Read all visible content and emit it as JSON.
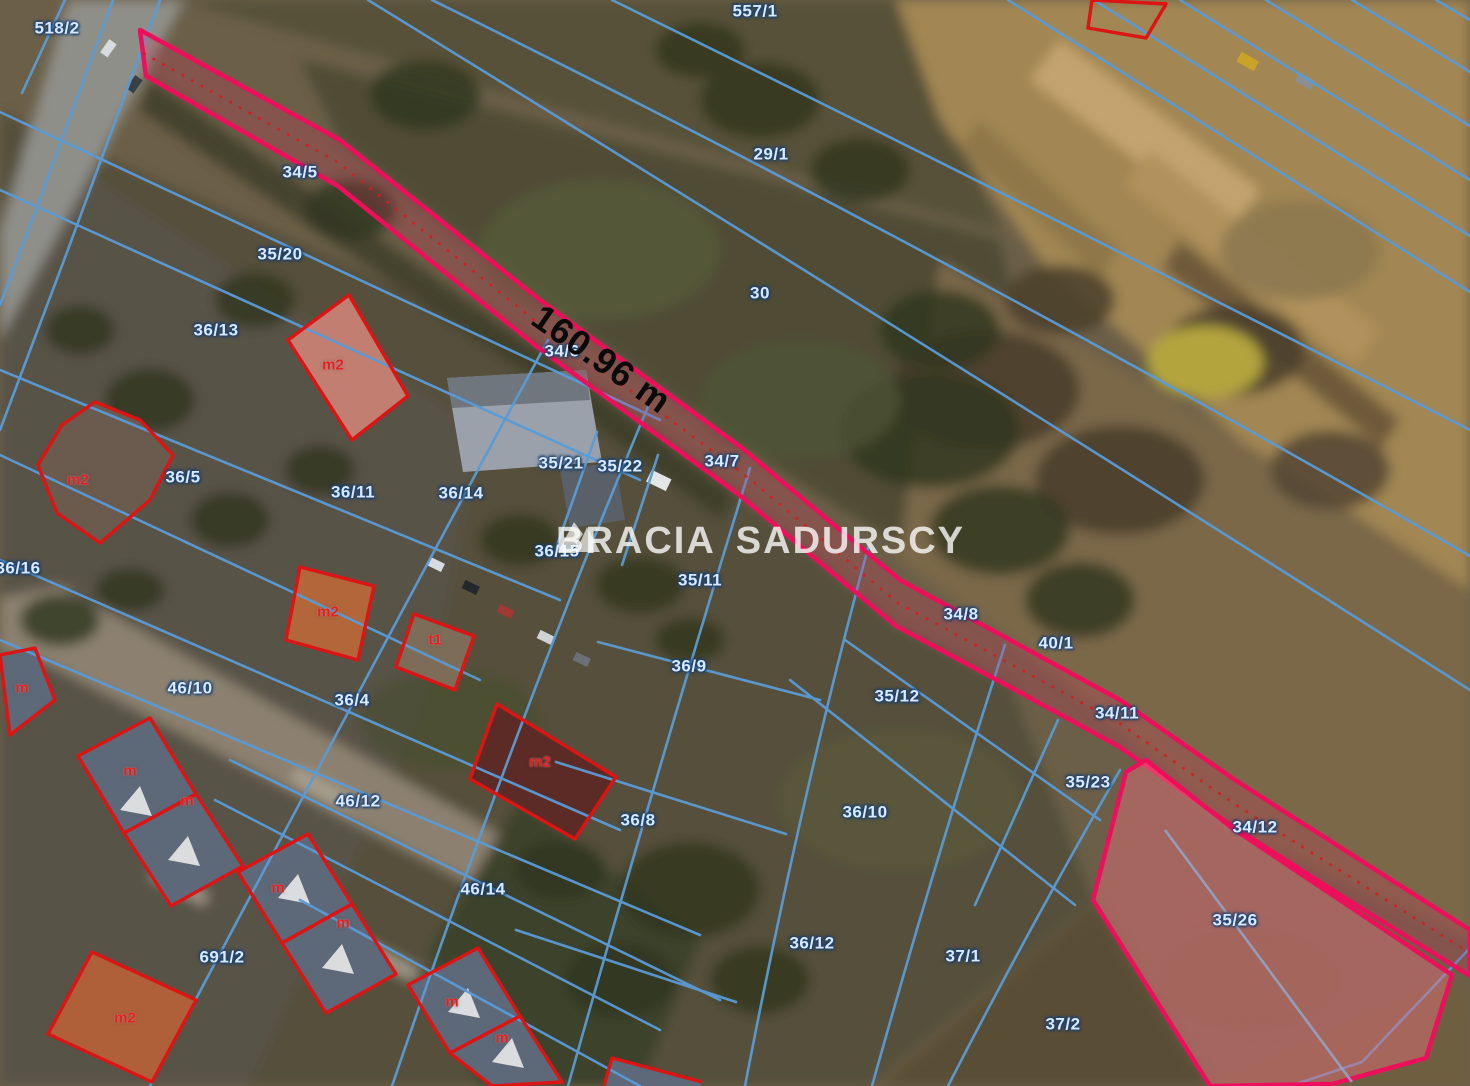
{
  "watermark": {
    "part1": "BRACIA",
    "part2": "SADURSCY",
    "logo": "triangle-logo"
  },
  "measurement": {
    "text": "160.96 m"
  },
  "colors": {
    "boundary_blue": "#5a9bd6",
    "highlight_magenta": "#ee0f5c",
    "building_red": "#dd1414",
    "parcel_label": "#dceaff",
    "building_label": "#e61e1e",
    "measurement_text": "#0a0a0a"
  },
  "parcel_labels": [
    {
      "text": "518/2",
      "x": 57,
      "y": 28
    },
    {
      "text": "557/1",
      "x": 755,
      "y": 11
    },
    {
      "text": "29/1",
      "x": 771,
      "y": 154
    },
    {
      "text": "30",
      "x": 760,
      "y": 293
    },
    {
      "text": "34/5",
      "x": 300,
      "y": 172
    },
    {
      "text": "35/20",
      "x": 280,
      "y": 254
    },
    {
      "text": "36/13",
      "x": 216,
      "y": 330
    },
    {
      "text": "34/6",
      "x": 562,
      "y": 351
    },
    {
      "text": "35/21",
      "x": 561,
      "y": 463
    },
    {
      "text": "35/22",
      "x": 620,
      "y": 466
    },
    {
      "text": "34/7",
      "x": 722,
      "y": 461
    },
    {
      "text": "36/5",
      "x": 183,
      "y": 477
    },
    {
      "text": "36/11",
      "x": 353,
      "y": 492
    },
    {
      "text": "36/14",
      "x": 461,
      "y": 493
    },
    {
      "text": "36/16",
      "x": 18,
      "y": 568
    },
    {
      "text": "36/15",
      "x": 557,
      "y": 551
    },
    {
      "text": "35/11",
      "x": 700,
      "y": 580
    },
    {
      "text": "34/8",
      "x": 961,
      "y": 614
    },
    {
      "text": "40/1",
      "x": 1056,
      "y": 643
    },
    {
      "text": "36/9",
      "x": 689,
      "y": 666
    },
    {
      "text": "46/10",
      "x": 190,
      "y": 688
    },
    {
      "text": "35/12",
      "x": 897,
      "y": 696
    },
    {
      "text": "36/4",
      "x": 352,
      "y": 700
    },
    {
      "text": "34/11",
      "x": 1117,
      "y": 713
    },
    {
      "text": "35/23",
      "x": 1088,
      "y": 782
    },
    {
      "text": "46/12",
      "x": 358,
      "y": 801
    },
    {
      "text": "36/10",
      "x": 865,
      "y": 812
    },
    {
      "text": "36/8",
      "x": 638,
      "y": 820
    },
    {
      "text": "34/12",
      "x": 1255,
      "y": 827
    },
    {
      "text": "46/14",
      "x": 483,
      "y": 889
    },
    {
      "text": "35/26",
      "x": 1235,
      "y": 920
    },
    {
      "text": "36/12",
      "x": 812,
      "y": 943
    },
    {
      "text": "37/1",
      "x": 963,
      "y": 956
    },
    {
      "text": "691/2",
      "x": 222,
      "y": 957
    },
    {
      "text": "37/2",
      "x": 1063,
      "y": 1024
    }
  ],
  "building_labels": [
    {
      "text": "m2",
      "x": 333,
      "y": 365
    },
    {
      "text": "m2",
      "x": 78,
      "y": 480
    },
    {
      "text": "m2",
      "x": 328,
      "y": 612
    },
    {
      "text": "t1",
      "x": 435,
      "y": 640
    },
    {
      "text": "m2",
      "x": 540,
      "y": 762
    },
    {
      "text": "m",
      "x": 22,
      "y": 688
    },
    {
      "text": "m",
      "x": 130,
      "y": 771
    },
    {
      "text": "m",
      "x": 187,
      "y": 801
    },
    {
      "text": "m",
      "x": 278,
      "y": 888
    },
    {
      "text": "m",
      "x": 343,
      "y": 923
    },
    {
      "text": "m",
      "x": 452,
      "y": 1002
    },
    {
      "text": "m2",
      "x": 125,
      "y": 1018
    },
    {
      "text": "m",
      "x": 502,
      "y": 1038
    }
  ]
}
